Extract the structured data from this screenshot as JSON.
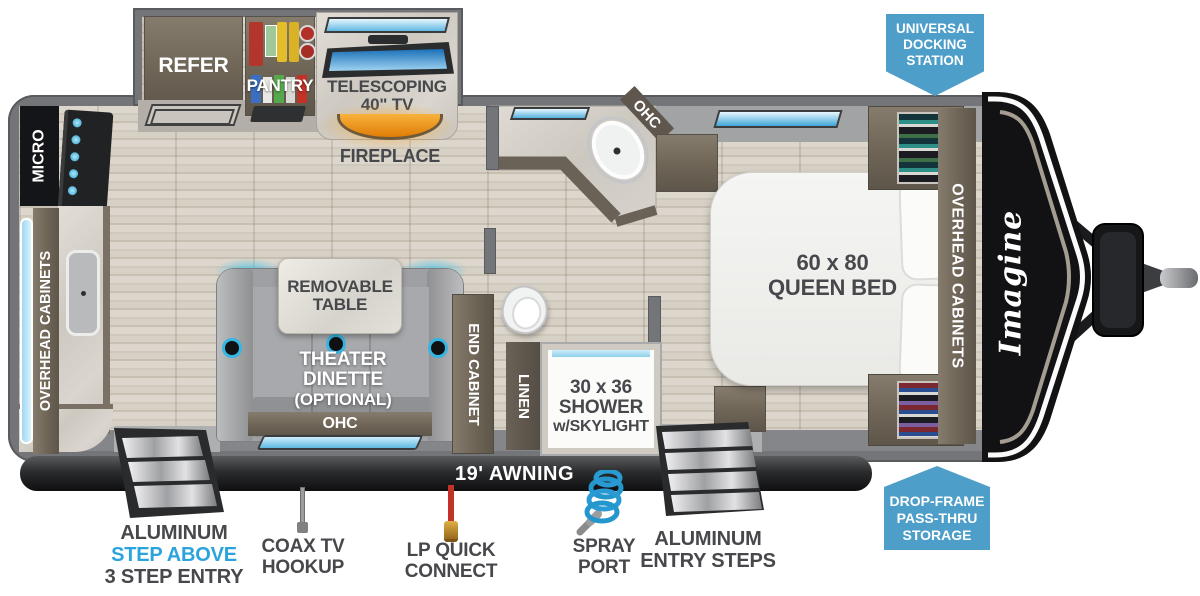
{
  "plan": {
    "kitchen": {
      "micro": "MICRO",
      "overhead": "OVERHEAD CABINETS",
      "refer": "REFER",
      "pantry": "PANTRY",
      "tv1": "TELESCOPING",
      "tv2": "40\" TV",
      "fireplace": "FIREPLACE"
    },
    "dinette": {
      "table1": "REMOVABLE",
      "table2": "TABLE",
      "name1": "THEATER DINETTE",
      "name2": "(OPTIONAL)",
      "ohc": "OHC",
      "end_cabinet": "END CABINET"
    },
    "bath": {
      "ohc": "OHC",
      "linen": "LINEN",
      "shower1": "30 x 36",
      "shower2": "SHOWER",
      "shower3": "w/SKYLIGHT"
    },
    "bedroom": {
      "bed1": "60 x 80",
      "bed2": "QUEEN BED",
      "overhead": "OVERHEAD CABINETS"
    },
    "exterior": {
      "awning": "19' AWNING",
      "logo": "Imagine"
    },
    "badges": {
      "dock1": "UNIVERSAL",
      "dock2": "DOCKING",
      "dock3": "STATION",
      "store1": "DROP-FRAME",
      "store2": "PASS-THRU",
      "store3": "STORAGE"
    },
    "callouts": {
      "steps_l1": "ALUMINUM",
      "steps_l2": "STEP ABOVE",
      "steps_l3": "3 STEP ENTRY",
      "coax1": "COAX TV",
      "coax2": "HOOKUP",
      "lp1": "LP QUICK",
      "lp2": "CONNECT",
      "spray1": "SPRAY",
      "spray2": "PORT",
      "steps_r1": "ALUMINUM",
      "steps_r2": "ENTRY STEPS"
    }
  },
  "colors": {
    "badge_blue": "#4d9ec9",
    "accent_blue": "#2ba3dc",
    "label_dark": "#47484b",
    "fire_orange": "#f59f1c"
  }
}
